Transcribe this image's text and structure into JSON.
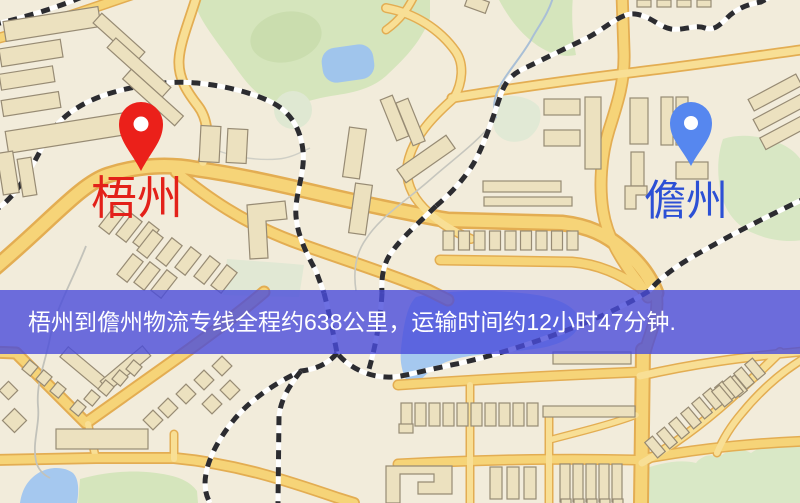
{
  "map": {
    "origin_marker": {
      "label": "梧州",
      "pin_color": "#eb201a",
      "label_color": "#e32119"
    },
    "destination_marker": {
      "label": "儋州",
      "pin_color": "#5687ef",
      "label_color": "#2c50d5"
    },
    "banner": {
      "text": "梧州到儋州物流专线全程约638公里，运输时间约12小时47分钟.",
      "bg_color": "#4a4cdb",
      "text_color": "#ffffff"
    },
    "palette": {
      "background": "#f2ecdb",
      "road": "#f6d478",
      "road_casing": "#e3ad52",
      "railway": "#2c2c30",
      "green_area": "#d5e5bc",
      "water": "#a5c8ef",
      "building": "#ece1bf"
    }
  }
}
